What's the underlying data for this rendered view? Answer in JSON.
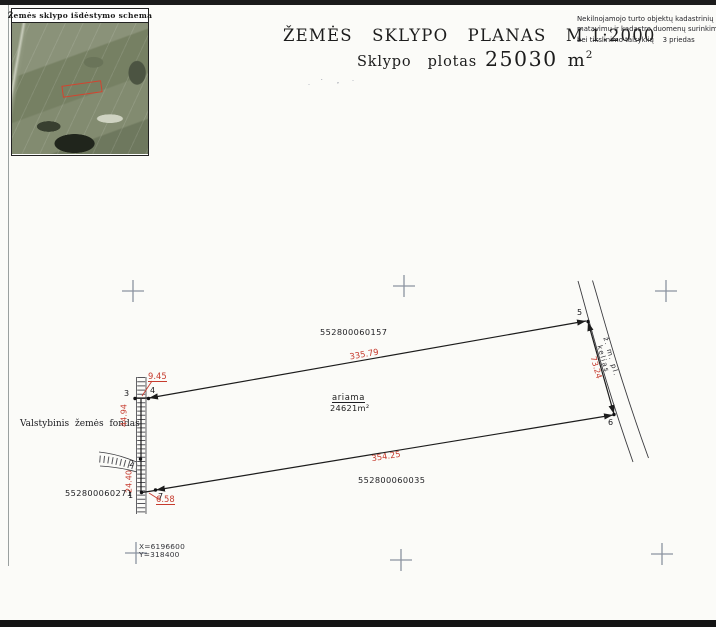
{
  "colors": {
    "paper": "#fbfbf8",
    "ink": "#1c1c1c",
    "dimension_red": "#c63b2e",
    "grid_cross_gray": "#8b93a0"
  },
  "inset": {
    "title": "Žemės sklypo išdėstymo schema"
  },
  "header": {
    "title": "ŽEMĖS   SKLYPO   PLANAS   M 1:2000",
    "area_label": "Sklypo   plotas",
    "area_value": "25030",
    "area_unit": "m",
    "area_exp": "2",
    "note_line1": "Nekilnojamojo turto objektų kadastrinių",
    "note_line2": "matavimų ir kadastro duomenų surinkimo",
    "note_line3": "bei tikslinimo taisyklių    3 priedas"
  },
  "plan": {
    "parcel_north": "552800060157",
    "parcel_south": "552800060035",
    "parcel_west": "552800060271",
    "west_owner": "Valstybinis žemės fondas",
    "land_use": "ariama",
    "land_use_area": "24621m²",
    "road_name": "ž. m. pl. kelias",
    "dim_top": "335.79",
    "dim_right": "73.24",
    "dim_bottom": "354.25",
    "dim_left_upper": "44.94",
    "dim_left_lower": "24.40",
    "dim_top_left": "9.45",
    "dim_bottom_left": "6.58",
    "pt1": "1",
    "pt2": "2",
    "pt3": "3",
    "pt4": "4",
    "pt5": "5",
    "pt6": "6",
    "pt7": "7",
    "coord_x": "X=6196600",
    "coord_y": "Y=318400"
  }
}
